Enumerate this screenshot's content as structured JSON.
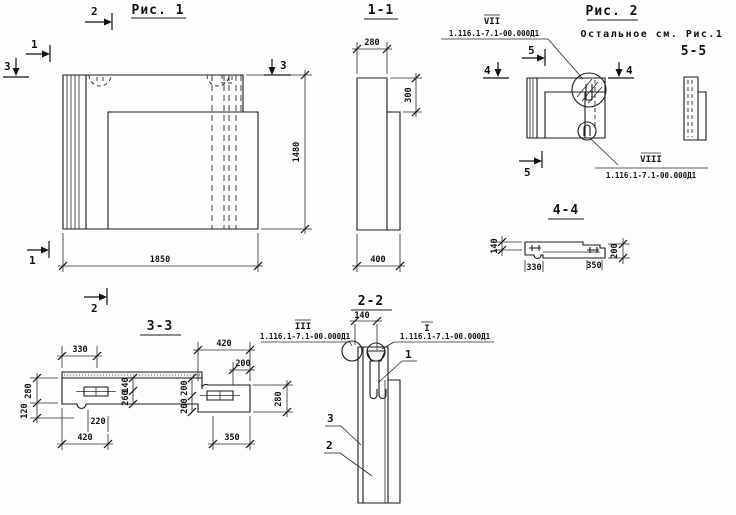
{
  "fig1": {
    "title": "Рис. 1",
    "dim_width": "1850",
    "dim_height": "1480",
    "marker_1": "1",
    "marker_2": "2",
    "marker_3": "3"
  },
  "sec11": {
    "title": "1-1",
    "dim_top": "280",
    "dim_step": "300",
    "dim_bottom": "400"
  },
  "fig2": {
    "title": "Рис. 2",
    "note": "Остальное см. Рис.1",
    "sec55_title": "5-5",
    "marker_4": "4",
    "marker_5": "5",
    "callout_vii": {
      "num": "VII",
      "doc": "1.116.1-7.1-00.000Д1"
    },
    "callout_viii": {
      "num": "VIII",
      "doc": "1.116.1-7.1-00.000Д1"
    }
  },
  "sec44": {
    "title": "4-4",
    "dim_140": "140",
    "dim_200": "200",
    "dim_330": "330",
    "dim_350": "350"
  },
  "sec33": {
    "title": "3-3",
    "dim_330": "330",
    "dim_420_top": "420",
    "dim_200_top": "200",
    "dim_280_left": "280",
    "dim_120": "120",
    "dim_140": "140",
    "dim_260": "260",
    "dim_200_mid": "200",
    "dim_200_low": "200",
    "dim_220": "220",
    "dim_420_bot": "420",
    "dim_350": "350",
    "dim_280_right": "280",
    "insert_label": "-1-"
  },
  "sec22": {
    "title": "2-2",
    "dim_140": "140",
    "callout_iii": {
      "num": "III",
      "doc": "1.116.1-7.1-00.000Д1"
    },
    "callout_i": {
      "num": "I",
      "doc": "1.116.1-7.1-00.000Д1"
    },
    "leader_1": "1",
    "leader_2": "2",
    "leader_3": "3"
  }
}
